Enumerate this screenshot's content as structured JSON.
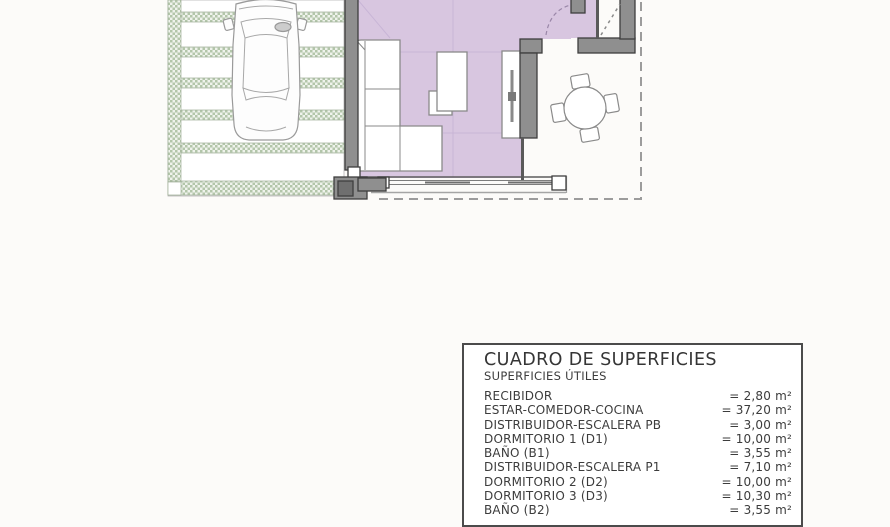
{
  "plan": {
    "colors": {
      "floor_purple": "#d8c6e0",
      "paving_green": "#b3c6aa",
      "wall_gray": "#8f8f8f",
      "boundary_gray": "#9c9c9c"
    },
    "features": [
      "carport-paving",
      "parked-car",
      "living-room-floor",
      "sofa",
      "coffee-table",
      "tv-unit",
      "window-wall",
      "terrace",
      "dining-table",
      "entry-stairs",
      "door-swing",
      "plot-boundary"
    ]
  },
  "table": {
    "title": "CUADRO DE SUPERFICIES",
    "subtitle": "SUPERFICIES ÚTILES",
    "rows": [
      {
        "label": "RECIBIDOR",
        "value": "= 2,80 m²"
      },
      {
        "label": "ESTAR-COMEDOR-COCINA",
        "value": "= 37,20 m²"
      },
      {
        "label": "DISTRIBUIDOR-ESCALERA PB",
        "value": "= 3,00 m²"
      },
      {
        "label": "DORMITORIO 1 (D1)",
        "value": "= 10,00 m²"
      },
      {
        "label": "BAÑO  (B1)",
        "value": "= 3,55 m²"
      },
      {
        "label": "DISTRIBUIDOR-ESCALERA P1",
        "value": "= 7,10 m²"
      },
      {
        "label": "DORMITORIO 2 (D2)",
        "value": "= 10,00 m²"
      },
      {
        "label": "DORMITORIO 3 (D3)",
        "value": "= 10,30 m²"
      },
      {
        "label": "BAÑO  (B2)",
        "value": "= 3,55 m²"
      }
    ]
  }
}
